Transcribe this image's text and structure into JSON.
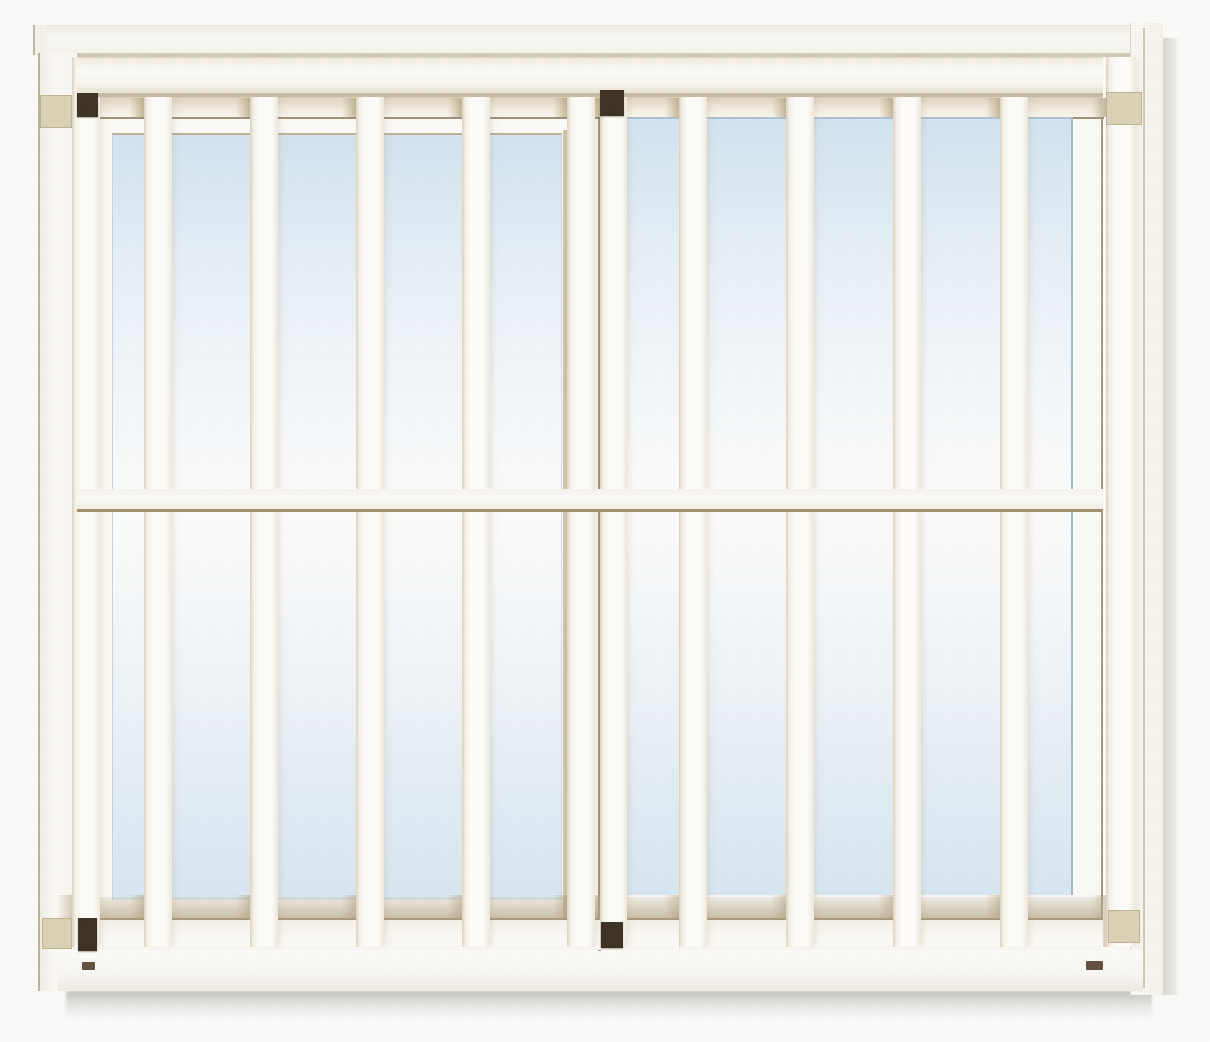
{
  "meta": {
    "title": "Window security grille product photograph",
    "description": "Catalog photograph of a white vertical-bar window security grille mounted over a two-panel sliding window with pale blue glass, dark mounting brackets and beige frame clips",
    "visible_text": "none",
    "interactive_elements": "none"
  },
  "palette": {
    "page_bg": "#fcfcfa",
    "frame_white": "#fbf9f4",
    "frame_shadow": "#d5cbba",
    "rail_line_brown": "#a3906f",
    "jamb_line": "#ab9a7e",
    "glass_top": "#d3e4ef",
    "glass_bottom": "#d9e7f1",
    "glass_edge": "#adc2d3",
    "sash_edge_blue": "#a4b8ca",
    "stile_tan": "#c7b8a0",
    "stile_line": "#87755c",
    "bracket_dark": "#3e3124",
    "clip_beige": "#dcd3b7",
    "clip_border": "#c0b493",
    "mark_brown": "#63503f"
  },
  "window": {
    "type": "two-panel sliding window",
    "panes": [
      {
        "side": "left",
        "x": 112,
        "y": 133,
        "w": 450,
        "h": 767
      },
      {
        "side": "right",
        "x": 625,
        "y": 117,
        "w": 448,
        "h": 778
      }
    ]
  },
  "grille": {
    "style": "vertical bars",
    "bar_count": 12,
    "rail_count": 3,
    "bar_top": 57,
    "bar_bottom": 947,
    "bars": [
      {
        "x": 72,
        "w": 28
      },
      {
        "x": 144,
        "w": 28
      },
      {
        "x": 250,
        "w": 28
      },
      {
        "x": 356,
        "w": 28
      },
      {
        "x": 462,
        "w": 28
      },
      {
        "x": 567,
        "w": 28
      },
      {
        "x": 600,
        "w": 27
      },
      {
        "x": 679,
        "w": 28
      },
      {
        "x": 786,
        "w": 28
      },
      {
        "x": 893,
        "w": 28
      },
      {
        "x": 1000,
        "w": 28
      },
      {
        "x": 1106,
        "w": 30
      }
    ]
  },
  "hardware": {
    "brackets_dark": [
      {
        "pos": "top-left",
        "x": 77,
        "y": 93,
        "w": 21,
        "h": 24
      },
      {
        "pos": "top-center",
        "x": 600,
        "y": 90,
        "w": 24,
        "h": 26
      },
      {
        "pos": "bottom-left",
        "x": 78,
        "y": 918,
        "w": 19,
        "h": 33
      },
      {
        "pos": "bottom-center",
        "x": 601,
        "y": 922,
        "w": 22,
        "h": 26
      }
    ],
    "clips_beige": [
      {
        "pos": "top-left",
        "x": 40,
        "y": 95,
        "w": 32,
        "h": 33
      },
      {
        "pos": "top-right",
        "x": 1106,
        "y": 92,
        "w": 36,
        "h": 33
      },
      {
        "pos": "bottom-left",
        "x": 42,
        "y": 918,
        "w": 30,
        "h": 31
      },
      {
        "pos": "bottom-right",
        "x": 1108,
        "y": 910,
        "w": 32,
        "h": 33
      }
    ],
    "screw_marks": [
      {
        "x": 82,
        "y": 962,
        "w": 13,
        "h": 8
      },
      {
        "x": 1086,
        "y": 961,
        "w": 17,
        "h": 9
      }
    ]
  }
}
